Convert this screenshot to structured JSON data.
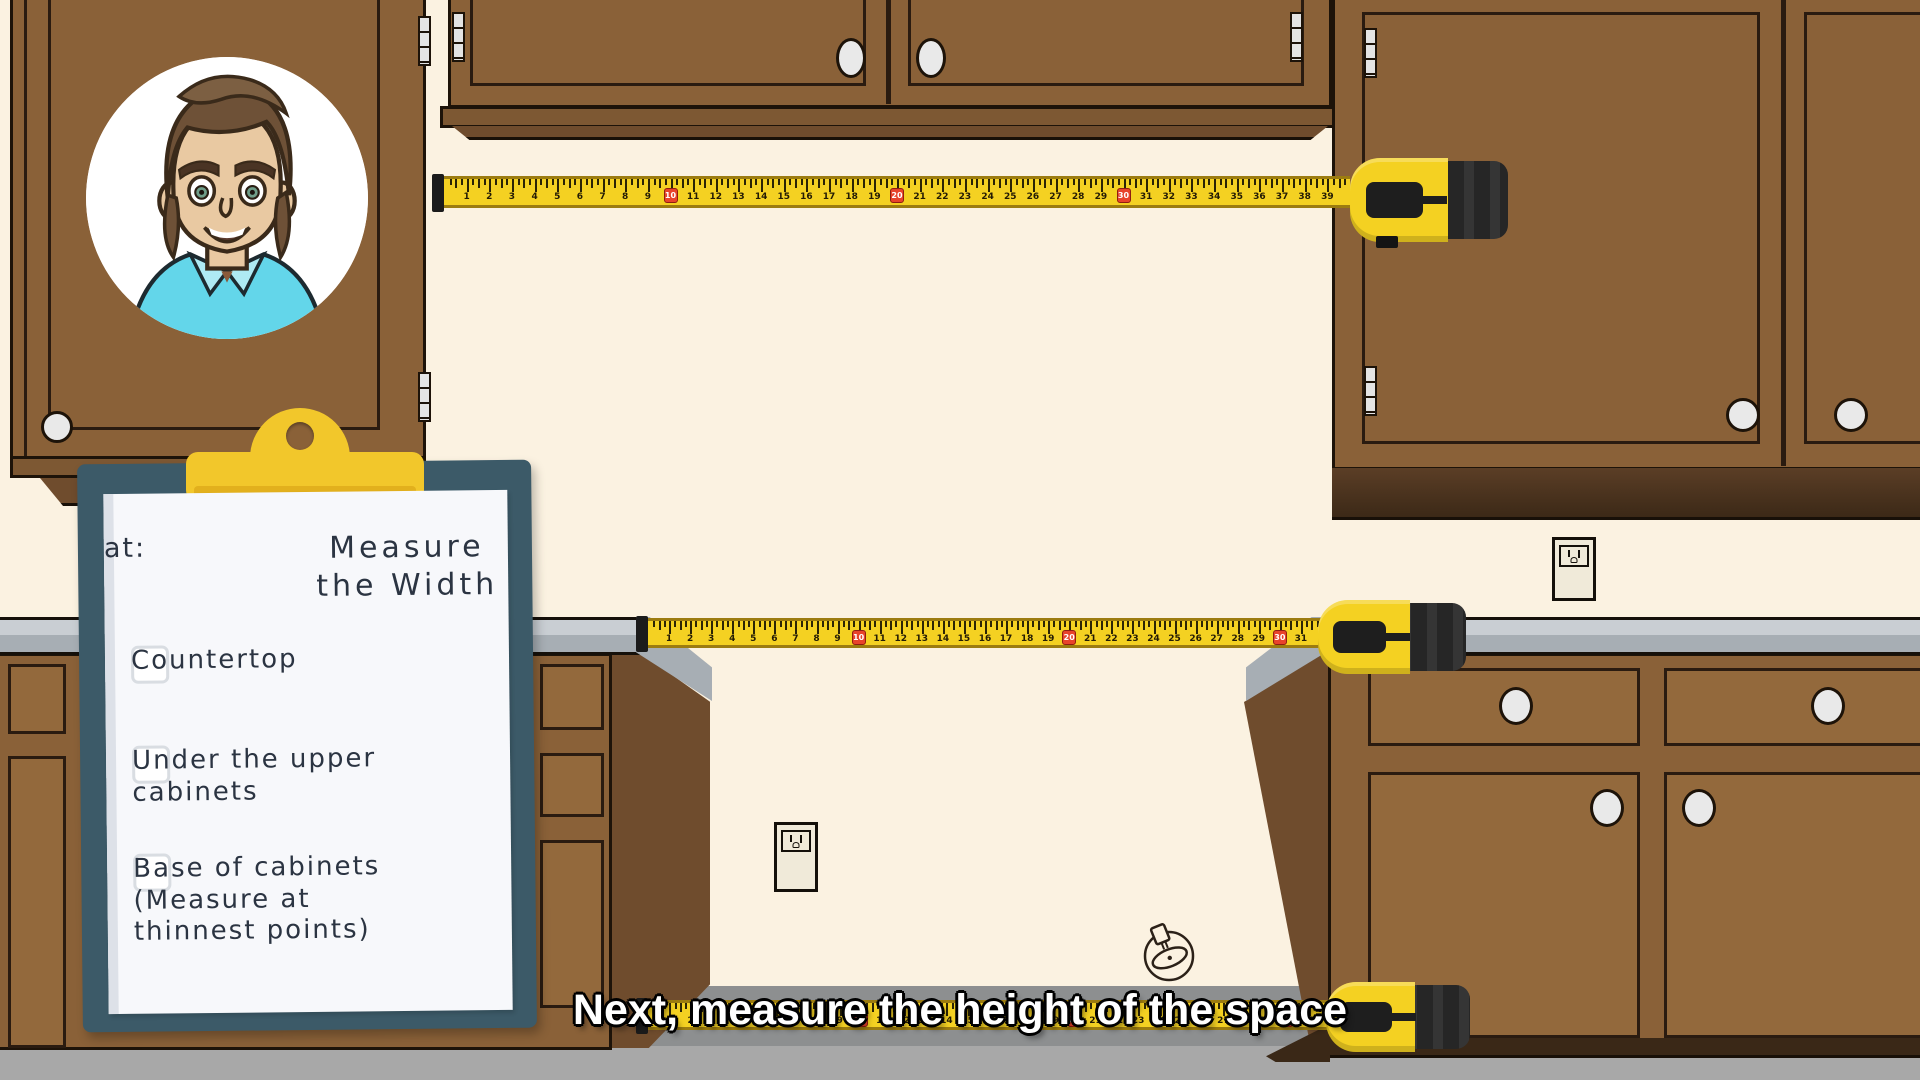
{
  "window": {
    "width": 1920,
    "height": 1080,
    "description": "Animated kitchen tutorial frame: measuring appliance space width"
  },
  "caption": {
    "text": "Next, measure the height of the space"
  },
  "clipboard": {
    "title": "Measure the Width",
    "title_suffix": "at:",
    "items": [
      {
        "label": "Countertop",
        "checked": false
      },
      {
        "label": "Under the upper cabinets",
        "checked": false
      },
      {
        "label": "Base of cabinets (Measure at thinnest points)",
        "checked": false
      }
    ]
  },
  "avatar": {
    "description": "cartoon man, brown hair, blue collared shirt, smiling"
  },
  "tapes": [
    {
      "name": "upper-tape-measure",
      "from": 1,
      "to": 39,
      "highlight_every": 10
    },
    {
      "name": "countertop-tape-measure",
      "from": 1,
      "to": 31,
      "highlight_every": 10
    },
    {
      "name": "bottom-tape-measure",
      "from": 1,
      "to": 31,
      "highlight_every": 10
    }
  ],
  "colors": {
    "wall": "#fbf2e1",
    "cabinet": "#8a6138",
    "cabinet_panel": "#93693c",
    "cabinet_dark": "#6f4c2d",
    "outline": "#1d1309",
    "counter_top": "#c9ced3",
    "counter_front": "#a7aeb4",
    "tape_yellow": "#f4d122",
    "tape_red": "#e8432b",
    "body_black": "#262626",
    "board": "#3c5a68",
    "clip_yellow": "#f2c72b",
    "clip_shadow": "#e2b01d",
    "paper": "#f7f8fb",
    "ink": "#2b3442",
    "checkbox": "#d9dde2",
    "caption_fill": "#ffffff",
    "floor": "#a8a8a8",
    "knob": "#e9e9e9",
    "hinge": "#e4e4e4",
    "outlet_plate": "#f0ead9",
    "shirt": "#63d6ea",
    "skin": "#e9c9a2",
    "hair": "#6e5137"
  }
}
